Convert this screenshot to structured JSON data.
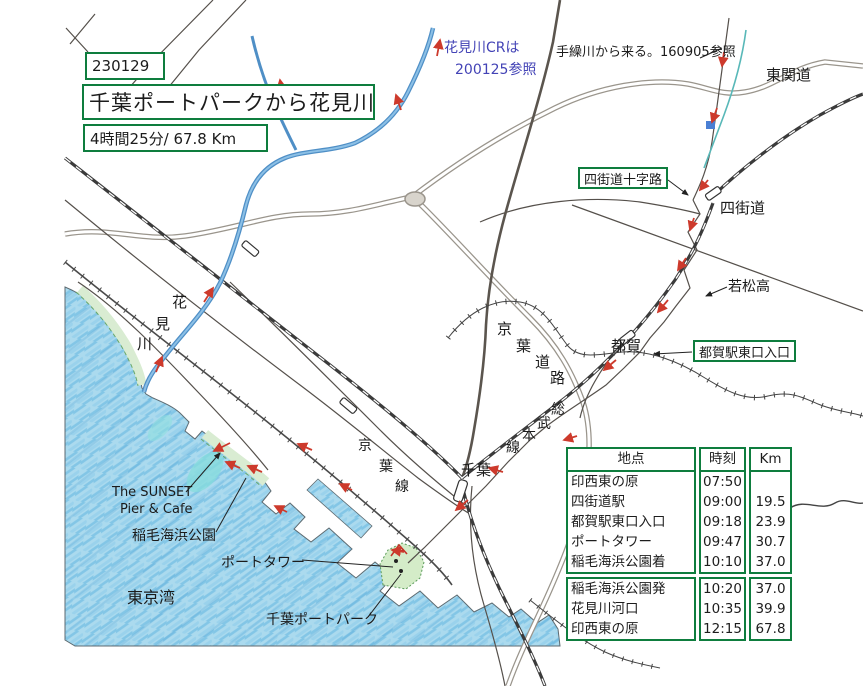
{
  "header": {
    "date": "230129",
    "title": "千葉ポートパークから花見川",
    "duration": "4時間25分/ 67.8 Km"
  },
  "annotations": {
    "hanamigawa_cr_1": "花見川CRは",
    "hanamigawa_cr_2": "200125参照",
    "tegurigawa": "手繰川から来る。160905参照",
    "higashikando": "東関道",
    "yotsukaido_junction": "四街道十字路",
    "yotsukaido": "四街道",
    "wakamatsuko": "若松高",
    "tsuga": "都賀",
    "tsuga_east_exit": "都賀駅東口入口",
    "chiba": "千葉",
    "tokyo_bay": "東京湾",
    "sunset_1": "The SUNSET",
    "sunset_2": "Pier & Cafe",
    "inage_park": "稲毛海浜公園",
    "port_tower": "ポートタワー",
    "chiba_port_park": "千葉ポートパーク",
    "keiyo_doro_chars": [
      "京",
      "葉",
      "道",
      "路"
    ],
    "sobu_honsen_chars": [
      "総",
      "武",
      "本",
      "線"
    ],
    "keiyo_sen_chars": [
      "京",
      "葉",
      "線"
    ],
    "hanamigawa_chars": [
      "花",
      "見",
      "川"
    ]
  },
  "table": {
    "headers": [
      "地点",
      "時刻",
      "Km"
    ],
    "block1": [
      {
        "point": "印西東の原",
        "time": "07:50",
        "km": ""
      },
      {
        "point": "四街道駅",
        "time": "09:00",
        "km": "19.5"
      },
      {
        "point": "都賀駅東口入口",
        "time": "09:18",
        "km": "23.9"
      },
      {
        "point": "ポートタワー",
        "time": "09:47",
        "km": "30.7"
      },
      {
        "point": "稲毛海浜公園着",
        "time": "10:10",
        "km": "37.0"
      }
    ],
    "block2": [
      {
        "point": "稲毛海浜公園発",
        "time": "10:20",
        "km": "37.0"
      },
      {
        "point": "花見川河口",
        "time": "10:35",
        "km": "39.9"
      },
      {
        "point": "印西東の原",
        "time": "12:15",
        "km": "67.8"
      }
    ]
  },
  "colors": {
    "box_green": "#0e7d3e",
    "route_red": "#cd3a2c",
    "river_blue": "#4f8fc6",
    "sea_blue": "#abdaee",
    "park_green": "#d9ecd2",
    "annotation_blue": "#4343b6"
  }
}
